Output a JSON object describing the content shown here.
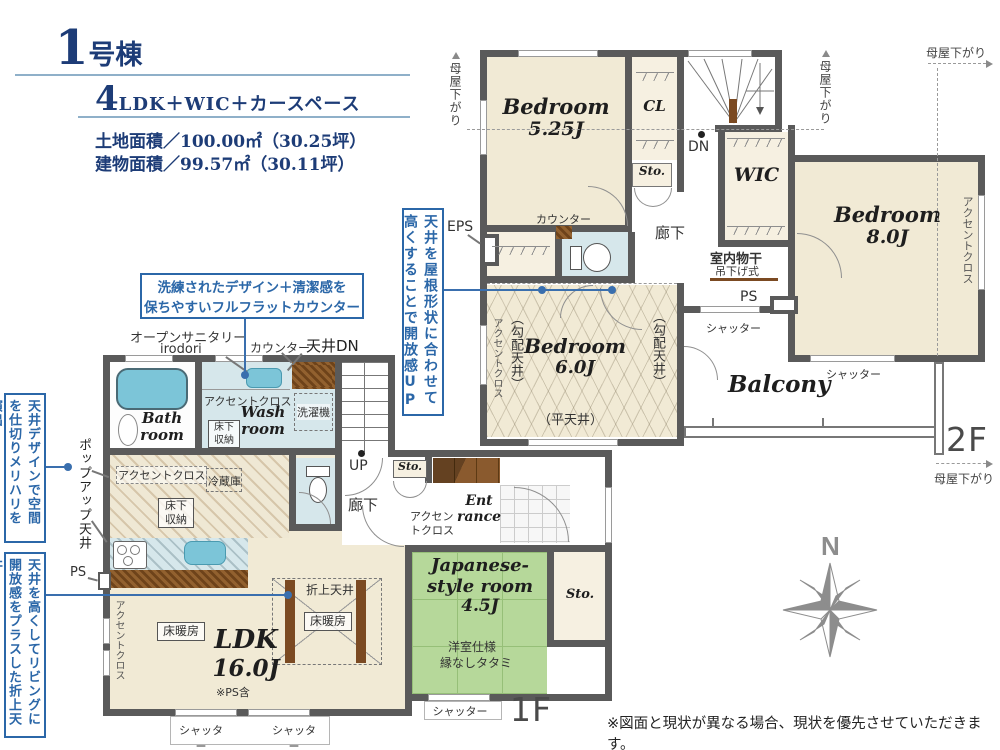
{
  "colors": {
    "wall": "#5a5a5a",
    "room_beige": "#f1ead5",
    "wet_blue": "#d6e7eb",
    "tatami_green": "#b6d89a",
    "accent_blue": "#2b67a8",
    "navy": "#1d3c77",
    "counter_brown": "#7b4a22",
    "gray_text": "#4a4a4a"
  },
  "header": {
    "building_no": "1",
    "building_suffix": "号棟",
    "plan_no": "4",
    "plan_text": "LDK＋WIC＋カースペース",
    "land_area": "土地面積／100.00㎡（30.25坪）",
    "building_area": "建物面積／99.57㎡（30.11坪）"
  },
  "callouts": {
    "roof_line1": "天井を屋根形状に合わせて",
    "roof_line2": "高くすることで開放感UP",
    "counter_line1": "洗練されたデザイン＋清潔感を",
    "counter_line2": "保ちやすいフルフラットカウンター",
    "partition_line1": "天井デザインで空間を",
    "partition_line2": "仕切りメリハリを演出",
    "coffered_line1": "天井を高くしてリビングに",
    "coffered_line2": "開放感をプラスした折上天井"
  },
  "floor2": {
    "label": "2F",
    "bedroom525_name": "Bedroom",
    "bedroom525_size": "5.25J",
    "bedroom8_name": "Bedroom",
    "bedroom8_size": "8.0J",
    "bedroom6_name": "Bedroom",
    "bedroom6_size": "6.0J",
    "wic": "WIC",
    "cl_top": "CL",
    "cl_bottom": "CL",
    "sto": "Sto.",
    "balcony": "Balcony",
    "hallway": "廊下",
    "dn": "DN",
    "eps": "EPS",
    "ps": "PS",
    "counter": "カウンター",
    "sloped_ceiling": "（勾配天井）",
    "flat_ceiling": "（平天井）",
    "accent_cloth": "アクセントクロス",
    "indoor_drying1": "室内物干",
    "indoor_drying2": "吊下げ式",
    "shutter": "シャッター",
    "moya_sagari": "母屋下がり"
  },
  "floor1": {
    "label": "1F",
    "bath_l1": "Bath",
    "bath_l2": "room",
    "wash_l1": "Wash",
    "wash_l2": "room",
    "ldk_l1": "LDK",
    "ldk_l2": "16.0J",
    "ldk_note": "※PS含",
    "floor_heating": "床暖房",
    "coffered": "折上天井",
    "jroom_l1": "Japanese-",
    "jroom_l2": "style room",
    "jroom_l3": "4.5J",
    "jroom_sub1": "洋室仕様",
    "jroom_sub2": "縁なしタタミ",
    "sto": "Sto.",
    "sto_hall": "Sto.",
    "entrance_l1": "Ent",
    "entrance_l2": "rance",
    "entrance_accent_l1": "アクセン",
    "entrance_accent_l2": "トクロス",
    "hallway": "廊下",
    "up": "UP",
    "ps": "PS",
    "accent_cloth": "アクセントクロス",
    "underfloor_l1": "床下",
    "underfloor_l2": "収納",
    "washer": "洗濯機",
    "fridge": "冷蔵庫",
    "counter": "カウンター",
    "ceiling_dn": "天井DN",
    "open_sanitary_l1": "オープンサニタリー",
    "open_sanitary_l2": "irodori",
    "popup_ceiling": "ポップアップ天井",
    "shutter": "シャッター"
  },
  "misc": {
    "compass_n": "N",
    "disclaimer": "※図面と現状が異なる場合、現状を優先させていただきます。"
  }
}
